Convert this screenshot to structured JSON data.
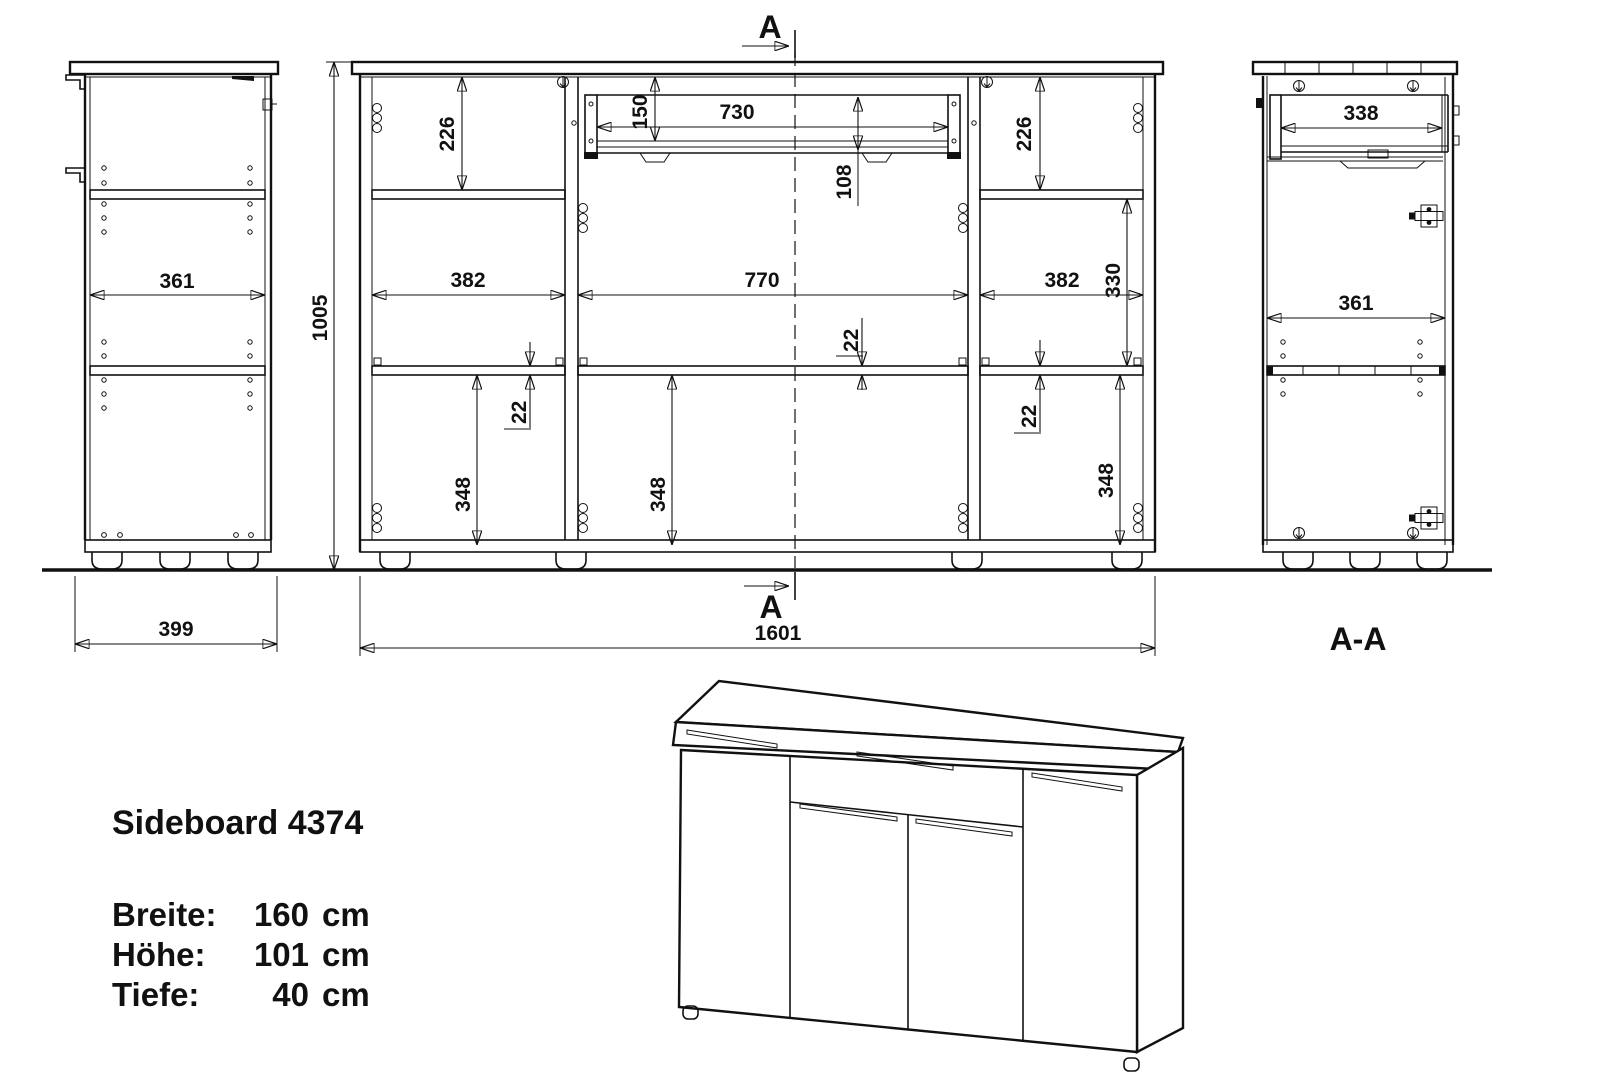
{
  "title_block": {
    "product": "Sideboard 4374",
    "specs": [
      {
        "label": "Breite:",
        "value": "160",
        "unit": "cm"
      },
      {
        "label": "Höhe:",
        "value": "101",
        "unit": "cm"
      },
      {
        "label": "Tiefe:",
        "value": "40",
        "unit": "cm"
      }
    ]
  },
  "markers": {
    "section_top": "A",
    "section_bottom": "A",
    "section_label": "A-A"
  },
  "dimensions": {
    "side_view": {
      "inner_width": "361",
      "total_depth": "399"
    },
    "front_view": {
      "total_height": "1005",
      "total_width": "1601",
      "cell_top_left": "226",
      "cell_top_right": "226",
      "drawer_height": "150",
      "drawer_width": "730",
      "below_drawer": "108",
      "cell_left": "382",
      "cell_middle": "770",
      "cell_right": "382",
      "cell_right_middle": "330",
      "shelf_left": "22",
      "shelf_middle": "22",
      "shelf_right": "22",
      "cell_bottom_left": "348",
      "cell_bottom_middle": "348",
      "cell_bottom_right": "348"
    },
    "section_view": {
      "drawer_depth": "338",
      "inner_depth": "361"
    }
  },
  "drawing_colors": {
    "line": "#111111",
    "background": "#ffffff"
  }
}
